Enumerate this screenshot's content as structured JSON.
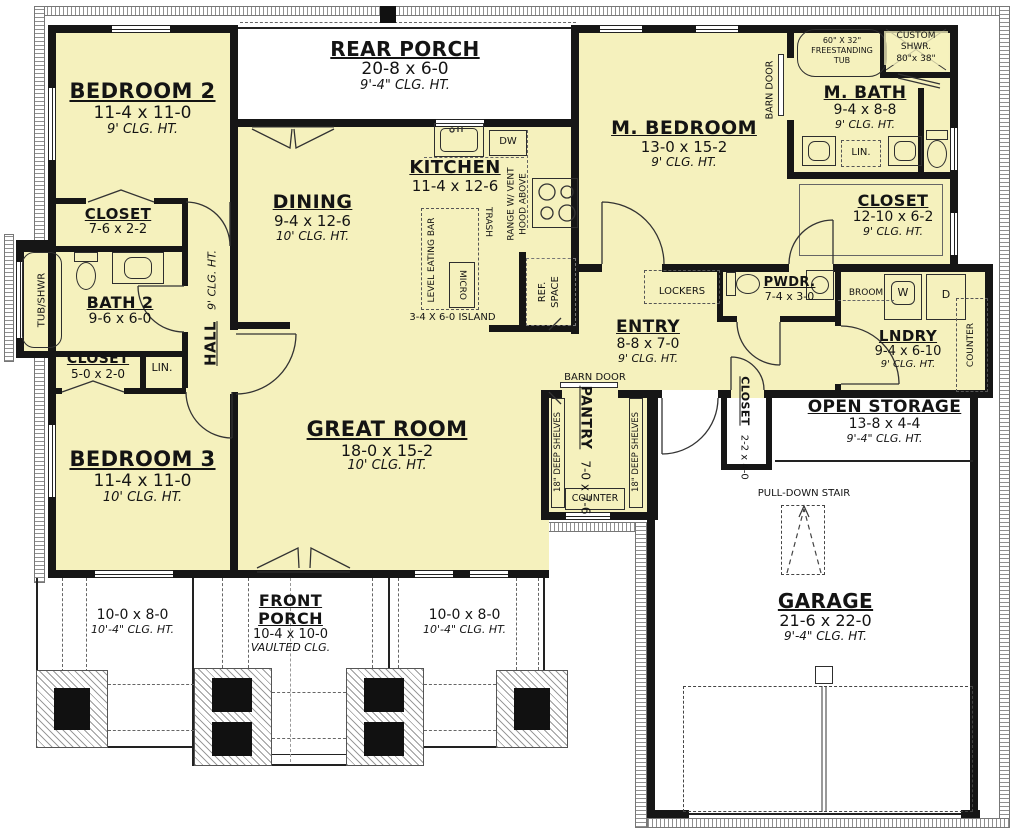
{
  "rooms": {
    "bedroom2": {
      "name": "BEDROOM 2",
      "dims": "11-4 x 11-0",
      "clg": "9' CLG. HT."
    },
    "closet_b2": {
      "name": "CLOSET",
      "dims": "7-6 x 2-2"
    },
    "bath2": {
      "name": "BATH 2",
      "dims": "9-6 x 6-0"
    },
    "closet_b3": {
      "name": "CLOSET",
      "dims": "5-0 x 2-0"
    },
    "hall": {
      "name": "HALL",
      "clg": "9' CLG. HT."
    },
    "bedroom3": {
      "name": "BEDROOM 3",
      "dims": "11-4 x 11-0",
      "clg": "10' CLG. HT."
    },
    "rear_porch": {
      "name": "REAR PORCH",
      "dims": "20-8 x 6-0",
      "clg": "9'-4\" CLG. HT."
    },
    "dining": {
      "name": "DINING",
      "dims": "9-4 x 12-6",
      "clg": "10' CLG. HT."
    },
    "kitchen": {
      "name": "KITCHEN",
      "dims": "11-4 x 12-6"
    },
    "great_room": {
      "name": "GREAT ROOM",
      "dims": "18-0 x 15-2",
      "clg": "10' CLG. HT."
    },
    "m_bedroom": {
      "name": "M. BEDROOM",
      "dims": "13-0 x 15-2",
      "clg": "9' CLG. HT."
    },
    "m_bath": {
      "name": "M. BATH",
      "dims": "9-4 x 8-8",
      "clg": "9' CLG. HT."
    },
    "m_closet": {
      "name": "CLOSET",
      "dims": "12-10 x 6-2",
      "clg": "9' CLG. HT."
    },
    "entry": {
      "name": "ENTRY",
      "dims": "8-8 x 7-0",
      "clg": "9' CLG. HT."
    },
    "pwdr": {
      "name": "PWDR.",
      "dims": "7-4 x 3-0"
    },
    "lndry": {
      "name": "LNDRY",
      "dims": "9-4 x 6-10",
      "clg": "9' CLG. HT."
    },
    "pantry": {
      "name": "PANTRY",
      "dims": "7-0 x 7-6"
    },
    "closet_gar": {
      "name": "CLOSET",
      "dims": "2-2 x 4-0"
    },
    "open_storage": {
      "name": "OPEN STORAGE",
      "dims": "13-8 x 4-4",
      "clg": "9'-4\" CLG. HT."
    },
    "garage": {
      "name": "GARAGE",
      "dims": "21-6 x 22-0",
      "clg": "9'-4\" CLG. HT."
    },
    "front_porch": {
      "name1": "FRONT",
      "name2": "PORCH",
      "dims": "10-4 x 10-0",
      "clg": "VAULTED CLG."
    },
    "side_porch": {
      "dims": "10-0 x 8-0",
      "clg": "10'-4\" CLG. HT."
    }
  },
  "labels": {
    "tub_shwr": "TUB/SHWR",
    "lin": "LIN.",
    "lockers": "LOCKERS",
    "broom": "BROOM",
    "washer": "W",
    "dryer": "D",
    "counter": "COUNTER",
    "dw": "DW",
    "trash": "TRASH",
    "micro": "MICRO",
    "level_eating_bar": "LEVEL EATING BAR",
    "island": "3-4 X 6-0 ISLAND",
    "range1": "RANGE W/ VENT",
    "range2": "HOOD ABOVE",
    "ref1": "REF.",
    "ref2": "SPACE",
    "shelves": "18\" DEEP SHELVES",
    "barn_door": "BARN DOOR",
    "pull_down": "PULL-DOWN STAIR",
    "tub1": "60\" X 32\"",
    "tub2": "FREESTANDING",
    "tub3": "TUB",
    "shwr1": "CUSTOM",
    "shwr2": "SHWR.",
    "shwr3": "80\"x 38\""
  }
}
